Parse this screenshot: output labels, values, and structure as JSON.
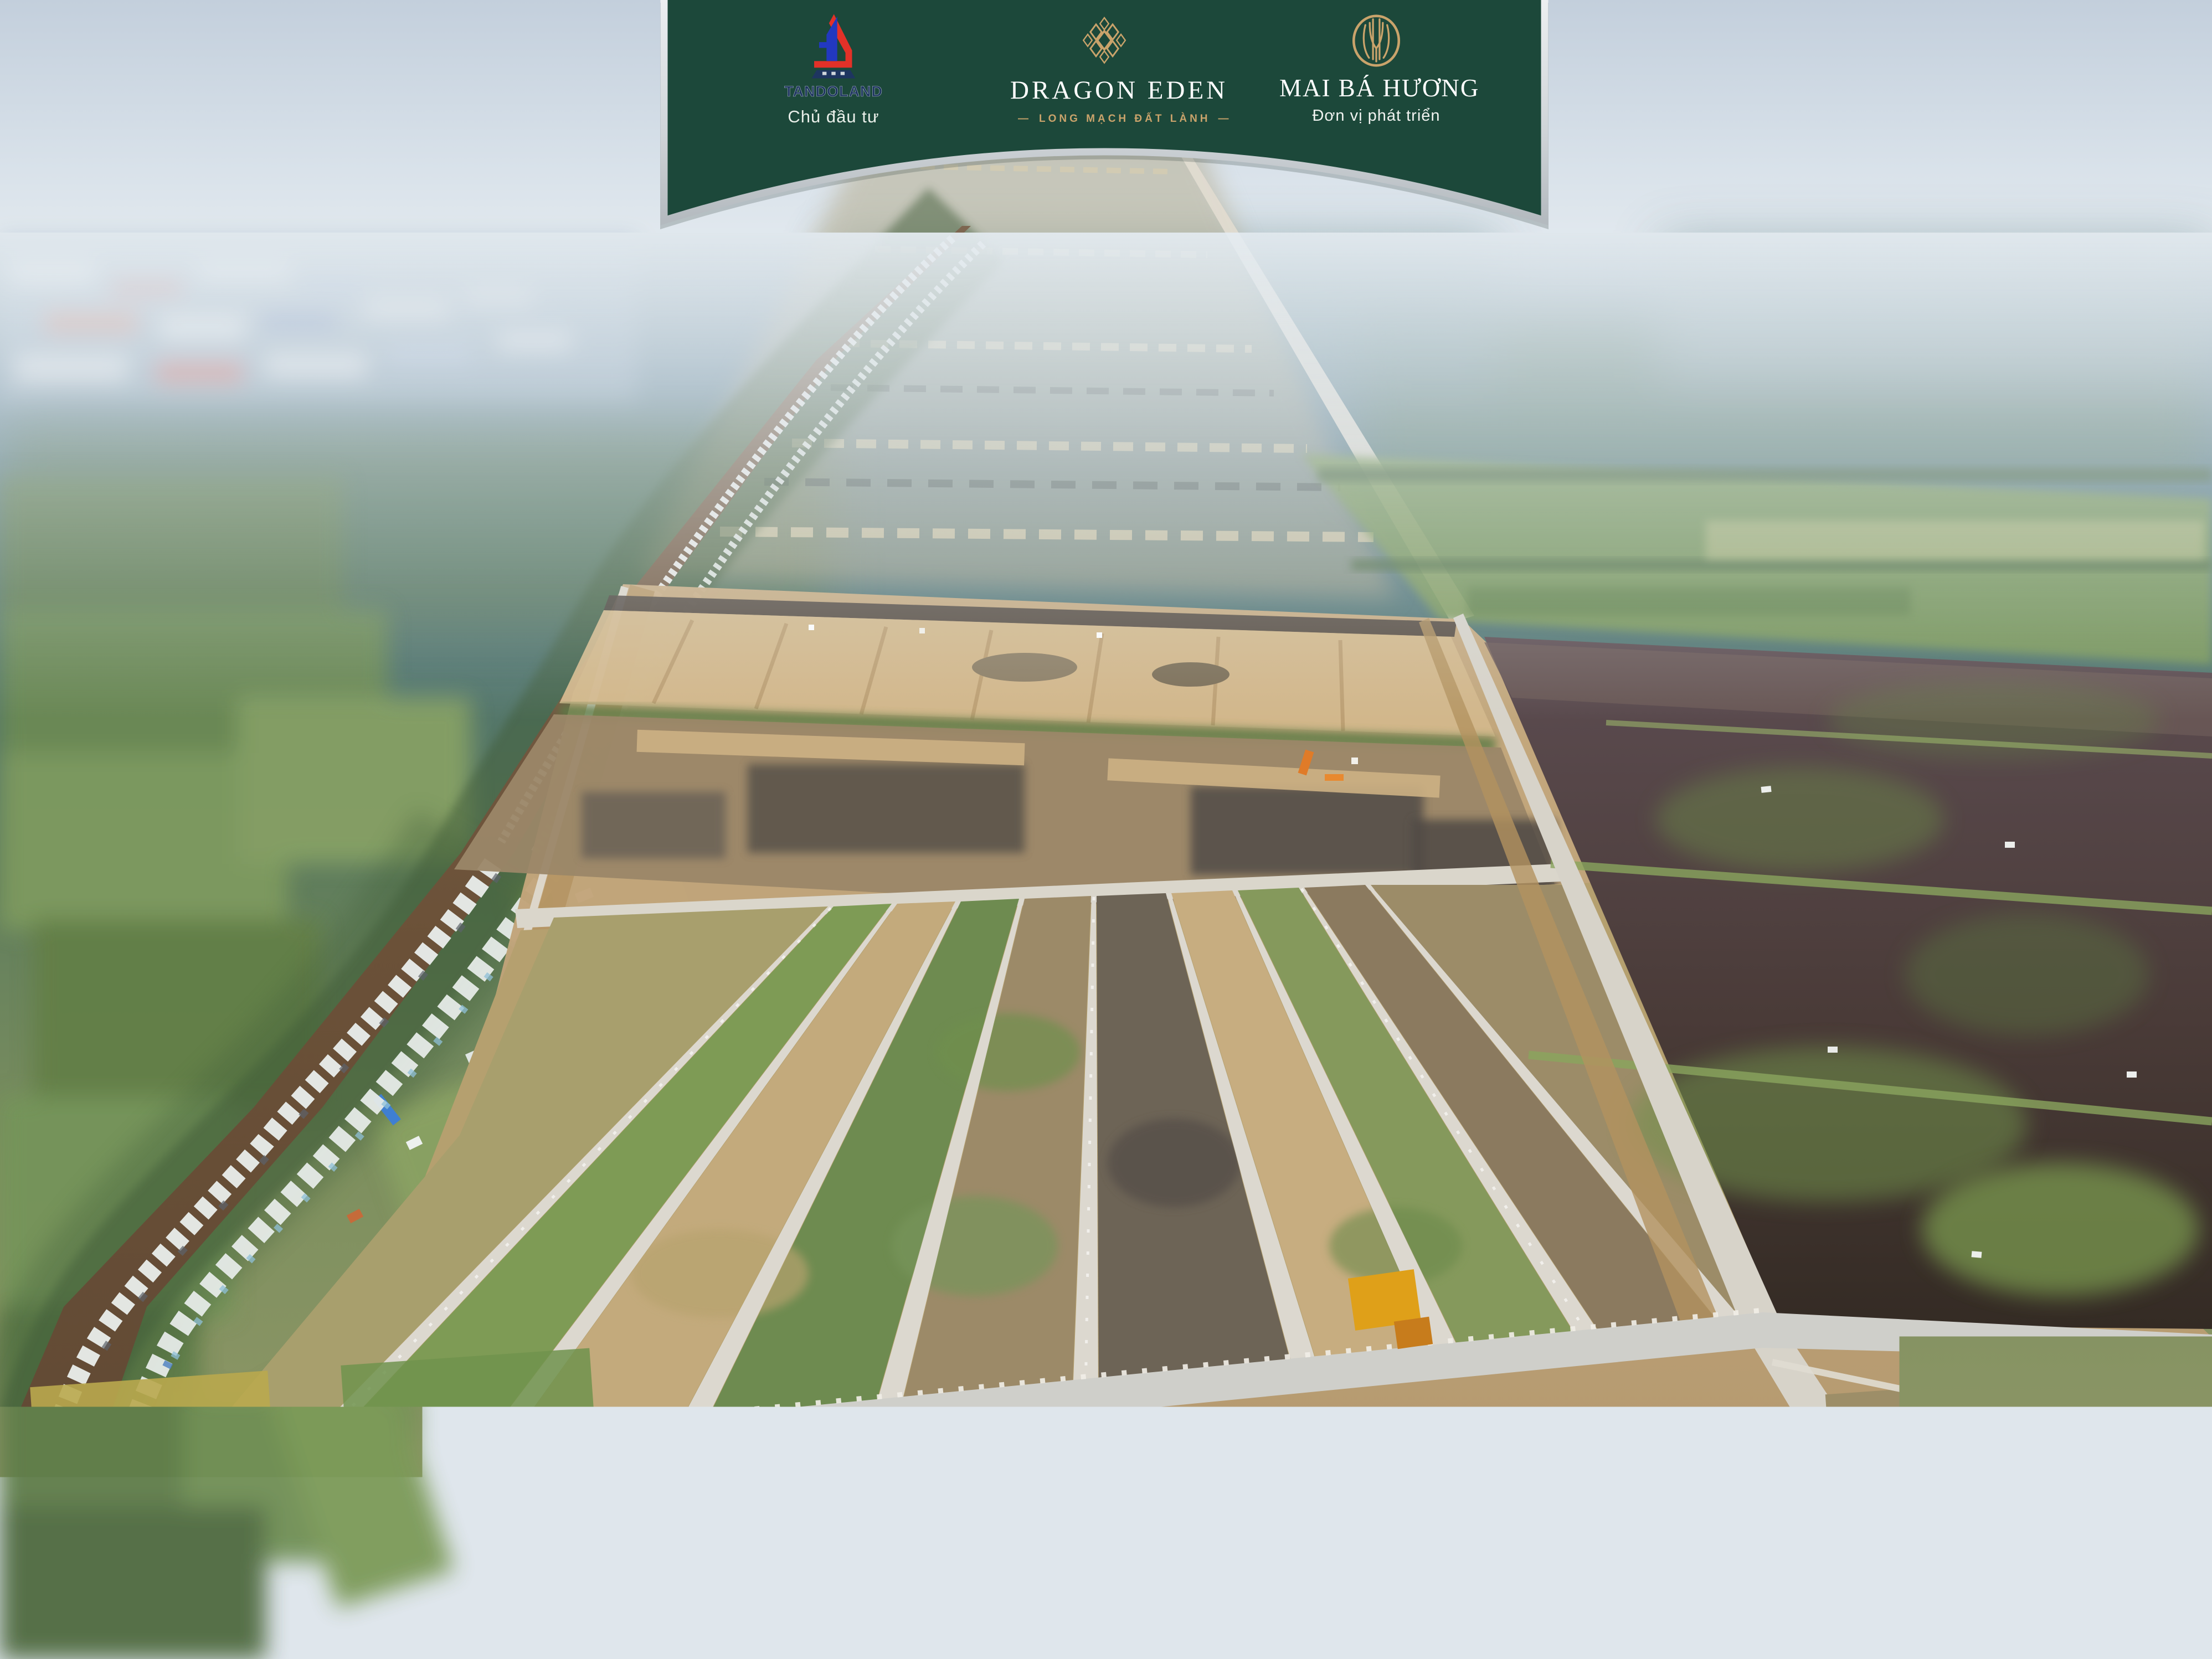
{
  "banner": {
    "background_color": "#1c483a",
    "border_color": "#c9ced2",
    "logos": [
      {
        "name": "TANDOLAND",
        "caption": "Chủ đầu tư",
        "icon": "tandoland-building-icon",
        "red": "#e23128",
        "blue": "#2238c0",
        "navy": "#1e3560"
      },
      {
        "name": "DRAGON EDEN",
        "caption": "LONG MẠCH ĐẤT LÀNH",
        "dash": "—",
        "icon": "dragon-eden-lattice-icon",
        "gold": "#c9a36b"
      },
      {
        "name": "MAI BÁ HƯƠNG",
        "caption": "Đơn vị phát triển",
        "icon": "mai-ba-huong-reed-circle-icon",
        "gold": "#c9a36b"
      }
    ]
  },
  "scene": {
    "description": "Aerial drone photo of a residential land development: tan graded plots with converging white roads in the center, a brown canal lined with village houses on the left, dark flooded paddies on the right, hazy farmland and an industrial zone at the horizon.",
    "palette": {
      "sky_haze": "#ccd7e2",
      "distant_ground_blue": "#4f7386",
      "farmland_green": "#6d8c52",
      "river_brown": "#6b5138",
      "village_roof_white": "#edf0ee",
      "development_tan": "#c2a378",
      "road_light": "#dcd8cf",
      "paddy_dark": "#43362f",
      "weed_green": "#71914c",
      "machine_orange": "#e07b28"
    }
  }
}
